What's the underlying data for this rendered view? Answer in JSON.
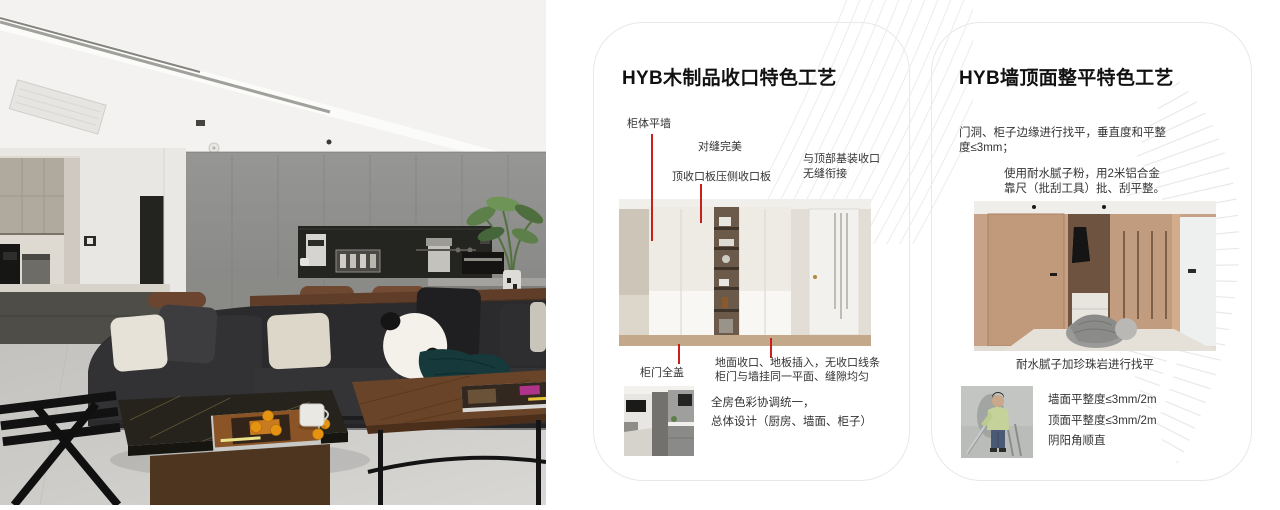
{
  "cards": [
    {
      "title": "HYB木制品收口特色工艺",
      "annotations": [
        "柜体平墙",
        "对缝完美",
        "顶收口板压侧收口板",
        "与顶部基装收口\n无缝衔接",
        "柜门全盖"
      ],
      "bottom_note": "地面收口、地板插入，无收口线条\n柜门与墙挂同一平面、缝隙均匀",
      "summary": "全房色彩协调统一，\n总体设计（厨房、墙面、柜子）"
    },
    {
      "title": "HYB墙顶面整平特色工艺",
      "para1": "门洞、柜子边缘进行找平，垂直度和平整\n度≤3mm；",
      "para2": "使用耐水腻子粉，用2米铝合金\n靠尺（批刮工具）批、刮平整。",
      "caption": "耐水腻子加珍珠岩进行找平",
      "notes": [
        "墙面平整度≤3mm/2m",
        "顶面平整度≤3mm/2m",
        "阴阳角顺直"
      ]
    }
  ],
  "colors": {
    "annotation_red": "#c9201b",
    "card_border": "#e8e8e8",
    "decor_line": "#ececec",
    "title_text": "#111111",
    "body_text": "#333333",
    "page_bg": "#ffffff"
  }
}
